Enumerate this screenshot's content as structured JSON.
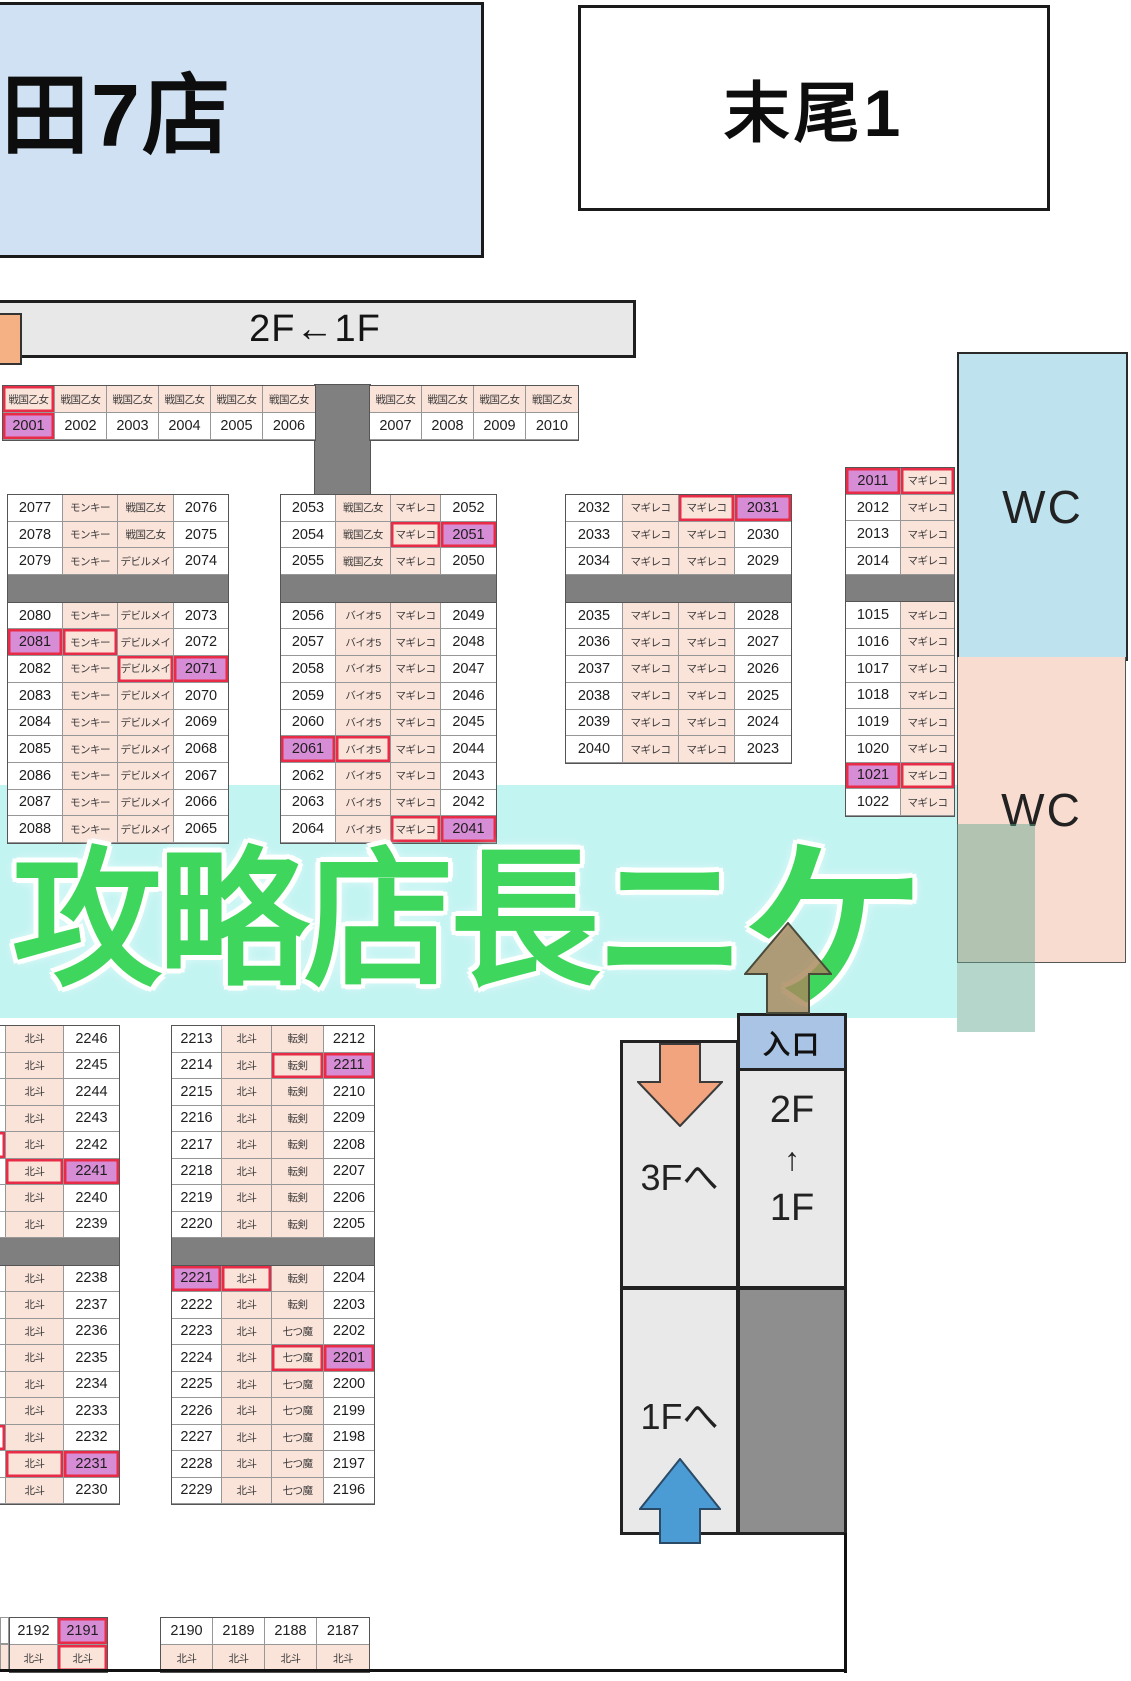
{
  "header": {
    "store_name_partial": "田7店",
    "section_label": "末尾1",
    "floor_strip_label": "2F←1F"
  },
  "wc": {
    "top_label": "WC",
    "bottom_label": "WC"
  },
  "watermark": {
    "text_main": "攻略店長ニ",
    "text_last": "ケ"
  },
  "stairs": {
    "entrance_label": "入口",
    "to_3f": "3Fへ",
    "to_1f": "1Fへ",
    "between": [
      "2F",
      "↑",
      "1F"
    ]
  },
  "palette": {
    "highlight_purple": "#d78cd6",
    "machine_cell_pink": "#fae3d9",
    "red_border": "#e82c48",
    "divider_gray": "#7f7f7f",
    "wc_blue": "#bfe2ef",
    "wc_pink": "#f9dcd0",
    "band_cyan": "#baf2f0",
    "watermark_green": "#3ed65c",
    "entrance_blue": "#a9c4e5",
    "arrow_orange": "#f2a47e",
    "arrow_blue": "#4b9bd5",
    "arrow_tan": "#a8875c",
    "store_box_blue": "#cfe1f2"
  },
  "blocks": [
    {
      "name": "strip-left",
      "x": 2,
      "y": 385,
      "row_h": 27,
      "cols": [
        {
          "kind": "num",
          "w": 52
        },
        {
          "kind": "num",
          "w": 52
        },
        {
          "kind": "num",
          "w": 52
        },
        {
          "kind": "num",
          "w": 52
        },
        {
          "kind": "num",
          "w": 52
        },
        {
          "kind": "num",
          "w": 52
        }
      ],
      "groups": [
        {
          "rows": [
            [
              {
                "t": "戦国乙女",
                "k": "label",
                "r": true
              },
              {
                "t": "戦国乙女",
                "k": "label"
              },
              {
                "t": "戦国乙女",
                "k": "label"
              },
              {
                "t": "戦国乙女",
                "k": "label"
              },
              {
                "t": "戦国乙女",
                "k": "label"
              },
              {
                "t": "戦国乙女",
                "k": "label"
              }
            ],
            [
              {
                "t": "2001",
                "hl": true,
                "r": true
              },
              "2002",
              "2003",
              "2004",
              "2005",
              "2006"
            ]
          ]
        }
      ]
    },
    {
      "name": "strip-right",
      "x": 369,
      "y": 385,
      "row_h": 27,
      "cols": [
        {
          "kind": "num",
          "w": 52
        },
        {
          "kind": "num",
          "w": 52
        },
        {
          "kind": "num",
          "w": 52
        },
        {
          "kind": "num",
          "w": 52
        }
      ],
      "groups": [
        {
          "rows": [
            [
              {
                "t": "戦国乙女",
                "k": "label"
              },
              {
                "t": "戦国乙女",
                "k": "label"
              },
              {
                "t": "戦国乙女",
                "k": "label"
              },
              {
                "t": "戦国乙女",
                "k": "label"
              }
            ],
            [
              "2007",
              "2008",
              "2009",
              "2010"
            ]
          ]
        }
      ]
    },
    {
      "name": "block-a",
      "x": 7,
      "y": 494,
      "row_h": 26.7,
      "cols": [
        {
          "kind": "num",
          "w": 55
        },
        {
          "kind": "label",
          "w": 55
        },
        {
          "kind": "label",
          "w": 56
        },
        {
          "kind": "num",
          "w": 54
        }
      ],
      "groups": [
        {
          "rows": [
            [
              "2077",
              "モンキー",
              "戦国乙女",
              "2076"
            ],
            [
              "2078",
              "モンキー",
              "戦国乙女",
              "2075"
            ],
            [
              "2079",
              "モンキー",
              "デビルメイ",
              "2074"
            ]
          ]
        },
        {
          "divider": true
        },
        {
          "rows": [
            [
              "2080",
              "モンキー",
              "デビルメイ",
              "2073"
            ],
            [
              {
                "t": "2081",
                "hl": true,
                "r": true
              },
              {
                "t": "モンキー",
                "r": true
              },
              "デビルメイ",
              "2072"
            ],
            [
              "2082",
              "モンキー",
              {
                "t": "デビルメイ",
                "r": true
              },
              {
                "t": "2071",
                "hl": true,
                "r": true
              }
            ],
            [
              "2083",
              "モンキー",
              "デビルメイ",
              "2070"
            ],
            [
              "2084",
              "モンキー",
              "デビルメイ",
              "2069"
            ],
            [
              "2085",
              "モンキー",
              "デビルメイ",
              "2068"
            ],
            [
              "2086",
              "モンキー",
              "デビルメイ",
              "2067"
            ],
            [
              "2087",
              "モンキー",
              "デビルメイ",
              "2066"
            ],
            [
              "2088",
              "モンキー",
              "デビルメイ",
              "2065"
            ]
          ]
        }
      ]
    },
    {
      "name": "block-b",
      "x": 280,
      "y": 494,
      "row_h": 26.7,
      "cols": [
        {
          "kind": "num",
          "w": 55
        },
        {
          "kind": "label",
          "w": 55
        },
        {
          "kind": "label",
          "w": 50
        },
        {
          "kind": "num",
          "w": 55
        }
      ],
      "groups": [
        {
          "rows": [
            [
              "2053",
              "戦国乙女",
              "マギレコ",
              "2052"
            ],
            [
              "2054",
              "戦国乙女",
              {
                "t": "マギレコ",
                "r": true
              },
              {
                "t": "2051",
                "hl": true,
                "r": true
              }
            ],
            [
              "2055",
              "戦国乙女",
              "マギレコ",
              "2050"
            ]
          ]
        },
        {
          "divider": true
        },
        {
          "rows": [
            [
              "2056",
              "バイオ5",
              "マギレコ",
              "2049"
            ],
            [
              "2057",
              "バイオ5",
              "マギレコ",
              "2048"
            ],
            [
              "2058",
              "バイオ5",
              "マギレコ",
              "2047"
            ],
            [
              "2059",
              "バイオ5",
              "マギレコ",
              "2046"
            ],
            [
              "2060",
              "バイオ5",
              "マギレコ",
              "2045"
            ],
            [
              {
                "t": "2061",
                "hl": true,
                "r": true
              },
              {
                "t": "バイオ5",
                "r": true
              },
              "マギレコ",
              "2044"
            ],
            [
              "2062",
              "バイオ5",
              "マギレコ",
              "2043"
            ],
            [
              "2063",
              "バイオ5",
              "マギレコ",
              "2042"
            ],
            [
              "2064",
              "バイオ5",
              {
                "t": "マギレコ",
                "r": true
              },
              {
                "t": "2041",
                "hl": true,
                "r": true
              }
            ]
          ]
        }
      ]
    },
    {
      "name": "block-c",
      "x": 565,
      "y": 494,
      "row_h": 26.7,
      "cols": [
        {
          "kind": "num",
          "w": 57
        },
        {
          "kind": "label",
          "w": 56
        },
        {
          "kind": "label",
          "w": 56
        },
        {
          "kind": "num",
          "w": 56
        }
      ],
      "groups": [
        {
          "rows": [
            [
              "2032",
              "マギレコ",
              {
                "t": "マギレコ",
                "r": true
              },
              {
                "t": "2031",
                "hl": true,
                "r": true
              }
            ],
            [
              "2033",
              "マギレコ",
              "マギレコ",
              "2030"
            ],
            [
              "2034",
              "マギレコ",
              "マギレコ",
              "2029"
            ]
          ]
        },
        {
          "divider": true
        },
        {
          "rows": [
            [
              "2035",
              "マギレコ",
              "マギレコ",
              "2028"
            ],
            [
              "2036",
              "マギレコ",
              "マギレコ",
              "2027"
            ],
            [
              "2037",
              "マギレコ",
              "マギレコ",
              "2026"
            ],
            [
              "2038",
              "マギレコ",
              "マギレコ",
              "2025"
            ],
            [
              "2039",
              "マギレコ",
              "マギレコ",
              "2024"
            ],
            [
              "2040",
              "マギレコ",
              "マギレコ",
              "2023"
            ]
          ]
        }
      ]
    },
    {
      "name": "block-d",
      "x": 845,
      "y": 467,
      "row_h": 26.7,
      "cols": [
        {
          "kind": "num",
          "w": 55
        },
        {
          "kind": "label",
          "w": 53
        }
      ],
      "groups": [
        {
          "rows": [
            [
              {
                "t": "2011",
                "hl": true,
                "r": true
              },
              {
                "t": "マギレコ",
                "r": true
              }
            ],
            [
              "2012",
              "マギレコ"
            ],
            [
              "2013",
              "マギレコ"
            ],
            [
              "2014",
              "マギレコ"
            ]
          ]
        },
        {
          "divider": true
        },
        {
          "rows": [
            [
              "1015",
              "マギレコ"
            ],
            [
              "1016",
              "マギレコ"
            ],
            [
              "1017",
              "マギレコ"
            ],
            [
              "1018",
              "マギレコ"
            ],
            [
              "1019",
              "マギレコ"
            ],
            [
              "1020",
              "マギレコ"
            ],
            [
              {
                "t": "1021",
                "hl": true,
                "r": true
              },
              {
                "t": "マギレコ",
                "r": true
              }
            ],
            [
              "1022",
              "マギレコ"
            ]
          ]
        }
      ]
    },
    {
      "name": "block-e",
      "x": 171,
      "y": 1025,
      "row_h": 26.5,
      "cols": [
        {
          "kind": "num",
          "w": 50
        },
        {
          "kind": "label",
          "w": 50
        },
        {
          "kind": "label",
          "w": 52
        },
        {
          "kind": "num",
          "w": 50
        }
      ],
      "groups": [
        {
          "rows": [
            [
              "2213",
              "北斗",
              "転剣",
              "2212"
            ],
            [
              "2214",
              "北斗",
              {
                "t": "転剣",
                "r": true
              },
              {
                "t": "2211",
                "hl": true,
                "r": true
              }
            ],
            [
              "2215",
              "北斗",
              "転剣",
              "2210"
            ],
            [
              "2216",
              "北斗",
              "転剣",
              "2209"
            ],
            [
              "2217",
              "北斗",
              "転剣",
              "2208"
            ],
            [
              "2218",
              "北斗",
              "転剣",
              "2207"
            ],
            [
              "2219",
              "北斗",
              "転剣",
              "2206"
            ],
            [
              "2220",
              "北斗",
              "転剣",
              "2205"
            ]
          ]
        },
        {
          "divider": true
        },
        {
          "rows": [
            [
              {
                "t": "2221",
                "hl": true,
                "r": true
              },
              {
                "t": "北斗",
                "r": true
              },
              "転剣",
              "2204"
            ],
            [
              "2222",
              "北斗",
              "転剣",
              "2203"
            ],
            [
              "2223",
              "北斗",
              "七つ魔",
              "2202"
            ],
            [
              "2224",
              "北斗",
              {
                "t": "七つ魔",
                "r": true
              },
              {
                "t": "2201",
                "hl": true,
                "r": true
              }
            ],
            [
              "2225",
              "北斗",
              "七つ魔",
              "2200"
            ],
            [
              "2226",
              "北斗",
              "七つ魔",
              "2199"
            ],
            [
              "2227",
              "北斗",
              "七つ魔",
              "2198"
            ],
            [
              "2228",
              "北斗",
              "七つ魔",
              "2197"
            ],
            [
              "2229",
              "北斗",
              "七つ魔",
              "2196"
            ]
          ]
        }
      ]
    },
    {
      "name": "block-f",
      "x": -45,
      "y": 1025,
      "row_h": 26.5,
      "cols": [
        {
          "kind": "num",
          "w": 50
        },
        {
          "kind": "label",
          "w": 58
        },
        {
          "kind": "num",
          "w": 55
        }
      ],
      "groups": [
        {
          "rows": [
            [
              "",
              "北斗",
              "2246"
            ],
            [
              "",
              "北斗",
              "2245"
            ],
            [
              "",
              "北斗",
              "2244"
            ],
            [
              "",
              "北斗",
              "2243"
            ],
            [
              {
                "t": "",
                "r": true
              },
              "北斗",
              "2242"
            ],
            [
              "",
              {
                "t": "北斗",
                "r": true
              },
              {
                "t": "2241",
                "hl": true,
                "r": true
              }
            ],
            [
              "",
              "北斗",
              "2240"
            ],
            [
              "",
              "北斗",
              "2239"
            ]
          ]
        },
        {
          "divider": true
        },
        {
          "rows": [
            [
              "",
              "北斗",
              "2238"
            ],
            [
              "",
              "北斗",
              "2237"
            ],
            [
              "",
              "北斗",
              "2236"
            ],
            [
              "",
              "北斗",
              "2235"
            ],
            [
              "",
              "北斗",
              "2234"
            ],
            [
              "",
              "北斗",
              "2233"
            ],
            [
              {
                "t": "",
                "r": true
              },
              "北斗",
              "2232"
            ],
            [
              "",
              {
                "t": "北斗",
                "r": true
              },
              {
                "t": "2231",
                "hl": true,
                "r": true
              }
            ],
            [
              "",
              "北斗",
              "2230"
            ]
          ]
        }
      ]
    },
    {
      "name": "block-g",
      "x": 9,
      "y": 1617,
      "row_h": 27,
      "cols": [
        {
          "kind": "num",
          "w": 48
        },
        {
          "kind": "num",
          "w": 49
        }
      ],
      "groups": [
        {
          "rows": [
            [
              "2192",
              {
                "t": "2191",
                "hl": true,
                "r": true
              }
            ],
            [
              {
                "t": "北斗",
                "k": "label"
              },
              {
                "t": "北斗",
                "k": "label",
                "r": true
              }
            ]
          ]
        }
      ]
    },
    {
      "name": "block-h",
      "x": 160,
      "y": 1617,
      "row_h": 27,
      "cols": [
        {
          "kind": "num",
          "w": 52
        },
        {
          "kind": "num",
          "w": 52
        },
        {
          "kind": "num",
          "w": 52
        },
        {
          "kind": "num",
          "w": 52
        }
      ],
      "groups": [
        {
          "rows": [
            [
              "2190",
              "2189",
              "2188",
              "2187"
            ],
            [
              {
                "t": "北斗",
                "k": "label"
              },
              {
                "t": "北斗",
                "k": "label"
              },
              {
                "t": "北斗",
                "k": "label"
              },
              {
                "t": "北斗",
                "k": "label"
              }
            ]
          ]
        }
      ]
    }
  ]
}
